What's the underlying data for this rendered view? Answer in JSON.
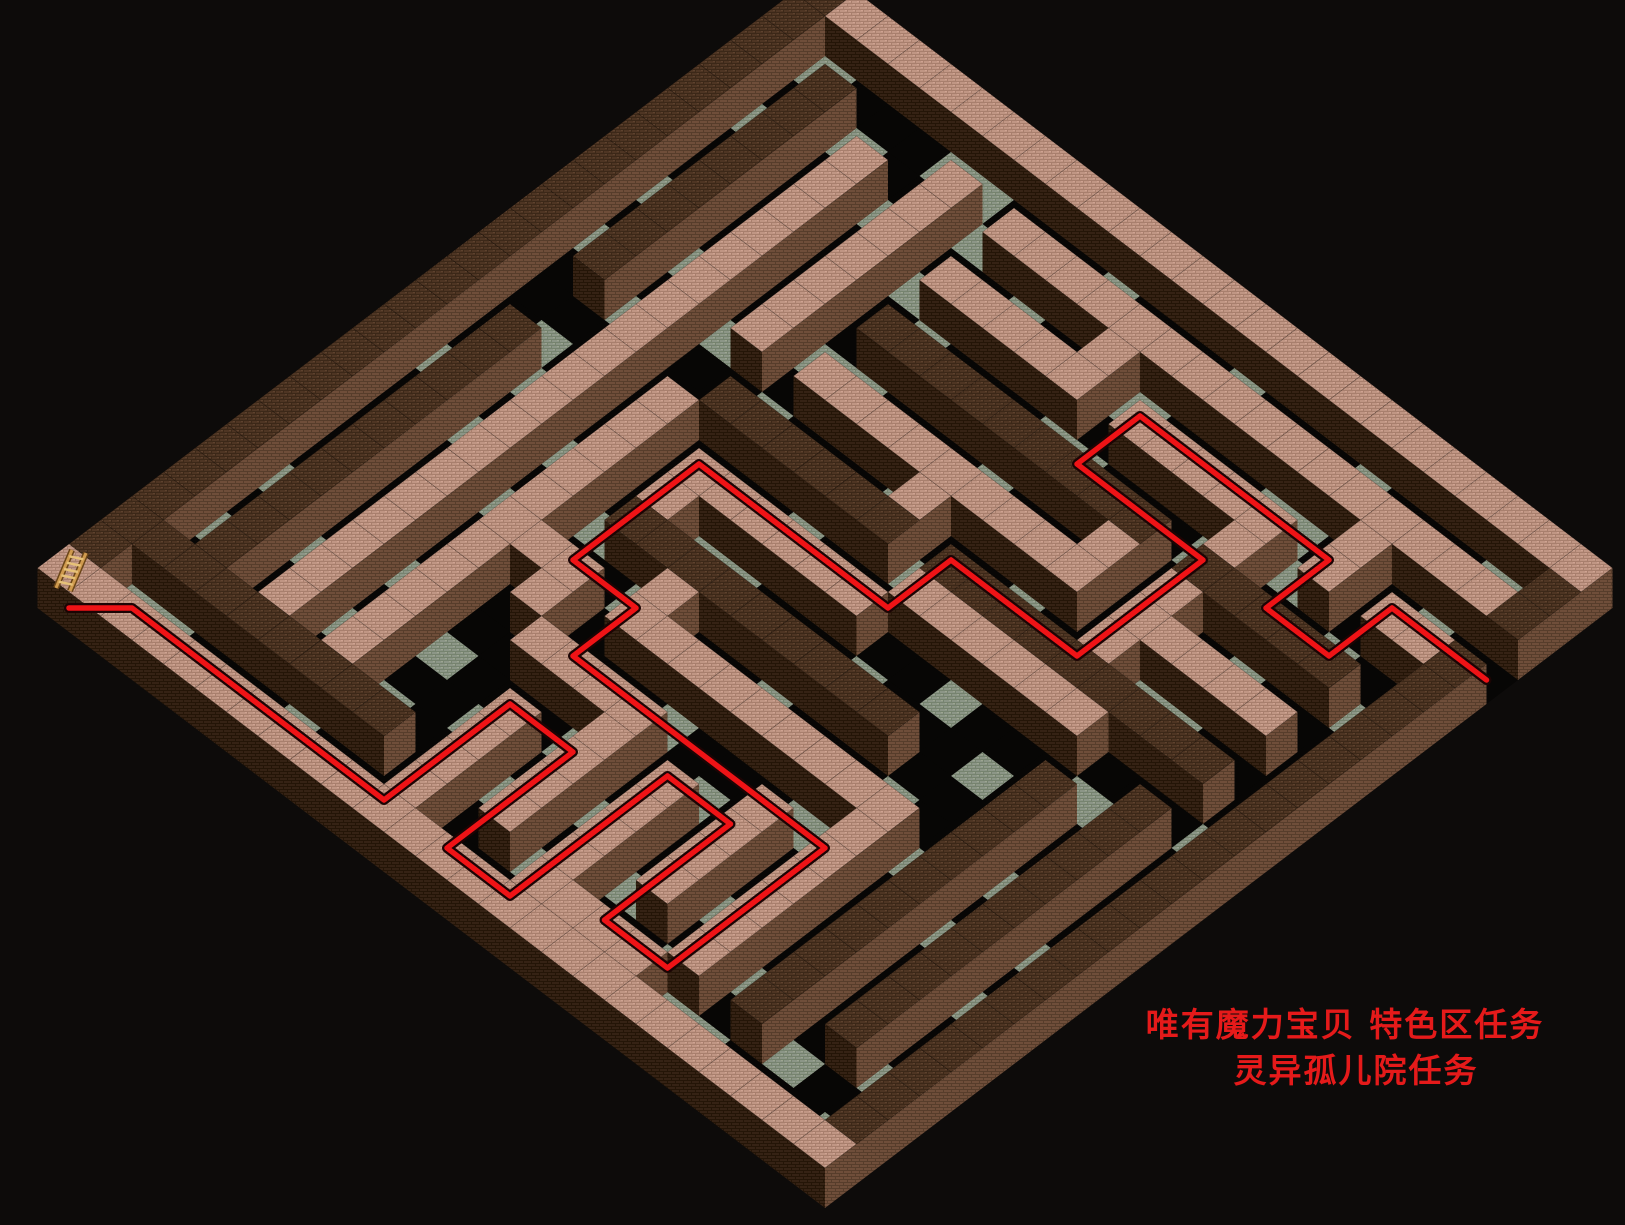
{
  "background": "#0d0b0a",
  "caption": {
    "line1": "唯有魔力宝贝 特色区任务",
    "line2": "灵异孤儿院任务",
    "color": "#e51a1a",
    "line1_x": 1345,
    "line1_y": 1022,
    "line2_x": 1356,
    "line2_y": 1068
  },
  "maze": {
    "legend": {
      "%": "dark-brick-wall",
      "#": "pink-brick-wall",
      ".": "floor"
    },
    "grid": [
      "%########################",
      "%.......................%",
      "%.%...#.################%",
      "%.%.#.#.....#.......#....",
      "%.%.#.#.#####.#####.#.##%",
      "%.%.#.#...........#.....%",
      "%.%.#.#.%%%%%%%%%.%%%%%.%",
      "%.%.#.#.........#.#.....%",
      "%.%.#.#.#########.#####.%",
      "%.%.#.......#.....#.....%",
      "%...#..%%%%%%.%%%%%%%%%.%",
      "%...#.#.......######....%",
      "%.%.#.#.######........%.%",
      "%.%.#.#.#...........%.%.%",
      "%.%.#.#.%%%%%%%%%...%.%.%",
      "%.%.#.#...#.........%.%.%",
      "%.%.#.###.#########.%.%.%",
      "%.%.#.#.#.........#.%.%.%",
      "%.%.#.#..####...#.#.%.%.%",
      "%.%.#.#.....#.#.#.#.%.%.%",
      "%.%.#.#...#.#.#.#.#.%.%.%",
      "%.%.#.#...#.#.#.#.#.%.%.%",
      "%%%%%%%%%.#.#.#...#.%...%",
      "%.........#...####......%",
      "#########################"
    ],
    "tile": {
      "w": 63,
      "h": 48,
      "wall_height": 40
    },
    "origin": {
      "x": 825,
      "y": 8
    },
    "colors": {
      "pink_top": {
        "base": "#c09684",
        "dark": "#a87f6d",
        "light": "#cfa392"
      },
      "dark_top": {
        "base": "#4e3523",
        "dark": "#3c2818",
        "light": "#5e422e"
      },
      "face_left": {
        "base": "#38241635",
        "solid": "#352214",
        "line": "#241507"
      },
      "face_right": {
        "base": "#6f4e3a",
        "line": "#573d2b"
      },
      "floor_lit": {
        "base": "#8c9687",
        "dark": "#76836f",
        "light": "#9da692"
      },
      "floor_dark": "#070605",
      "path": "#ef1316",
      "path_halo": "#1c0404"
    },
    "path_waypoints": [
      [
        24,
        0
      ],
      [
        23,
        1
      ],
      [
        23,
        9
      ],
      [
        19,
        9
      ],
      [
        19,
        11
      ],
      [
        23,
        11
      ],
      [
        23,
        13
      ],
      [
        18,
        13
      ],
      [
        18,
        15
      ],
      [
        22,
        15
      ],
      [
        22,
        17
      ],
      [
        17,
        17
      ],
      [
        17,
        9
      ],
      [
        15,
        9
      ],
      [
        15,
        7
      ],
      [
        11,
        7
      ],
      [
        11,
        13
      ],
      [
        9,
        13
      ],
      [
        9,
        17
      ],
      [
        5,
        17
      ],
      [
        5,
        13
      ],
      [
        3,
        13
      ],
      [
        3,
        19
      ],
      [
        5,
        19
      ],
      [
        5,
        21
      ],
      [
        3,
        21
      ],
      [
        3,
        24
      ]
    ],
    "ladder_cell": [
      24,
      0
    ],
    "exit_cell": [
      3,
      24
    ]
  }
}
